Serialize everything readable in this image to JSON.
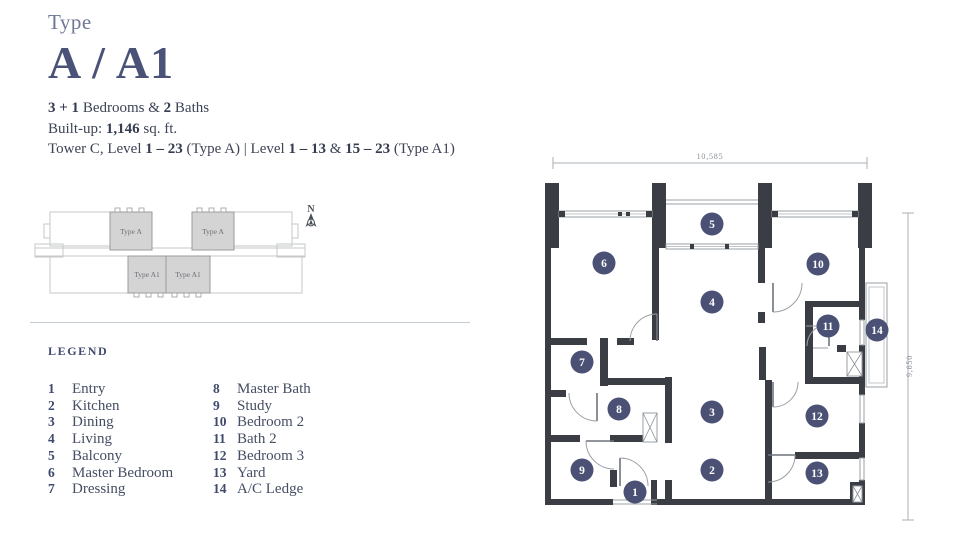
{
  "header": {
    "type_label": "Type",
    "title": "A / A1",
    "specs": {
      "beds_bold": "3 + 1",
      "beds_text": " Bedrooms & ",
      "baths_bold": "2",
      "baths_text": " Baths",
      "builtup_label": "Built-up: ",
      "builtup_value": "1,146",
      "builtup_suffix": " sq. ft.",
      "tower_prefix": "Tower C, Level ",
      "tower_range_a": "1 – 23",
      "tower_mid": " (Type A)  |  Level ",
      "tower_range_b1": "1 – 13",
      "tower_amp": " & ",
      "tower_range_b2": "15 – 23",
      "tower_suffix": " (Type A1)"
    }
  },
  "siteplan": {
    "north_label": "N",
    "blocks": [
      "Type A",
      "Type A",
      "Type A1",
      "Type A1"
    ]
  },
  "legend": {
    "title": "LEGEND",
    "col1": [
      {
        "num": "1",
        "label": "Entry"
      },
      {
        "num": "2",
        "label": "Kitchen"
      },
      {
        "num": "3",
        "label": "Dining"
      },
      {
        "num": "4",
        "label": "Living"
      },
      {
        "num": "5",
        "label": "Balcony"
      },
      {
        "num": "6",
        "label": "Master Bedroom"
      },
      {
        "num": "7",
        "label": "Dressing"
      }
    ],
    "col2": [
      {
        "num": "8",
        "label": "Master Bath"
      },
      {
        "num": "9",
        "label": "Study"
      },
      {
        "num": "10",
        "label": "Bedroom 2"
      },
      {
        "num": "11",
        "label": "Bath 2"
      },
      {
        "num": "12",
        "label": "Bedroom 3"
      },
      {
        "num": "13",
        "label": "Yard"
      },
      {
        "num": "14",
        "label": "A/C Ledge"
      }
    ]
  },
  "floorplan": {
    "width_label": "10,585",
    "height_label": "9,650",
    "rooms": [
      {
        "num": "1",
        "name": "Entry"
      },
      {
        "num": "2",
        "name": "Kitchen"
      },
      {
        "num": "3",
        "name": "Dining"
      },
      {
        "num": "4",
        "name": "Living"
      },
      {
        "num": "5",
        "name": "Balcony"
      },
      {
        "num": "6",
        "name": "Master Bedroom"
      },
      {
        "num": "7",
        "name": "Dressing"
      },
      {
        "num": "8",
        "name": "Master Bath"
      },
      {
        "num": "9",
        "name": "Study"
      },
      {
        "num": "10",
        "name": "Bedroom 2"
      },
      {
        "num": "11",
        "name": "Bath 2"
      },
      {
        "num": "12",
        "name": "Bedroom 3"
      },
      {
        "num": "13",
        "name": "Yard"
      },
      {
        "num": "14",
        "name": "A/C Ledge"
      }
    ]
  },
  "colors": {
    "accent": "#4a5377",
    "wall": "#3a3d44",
    "marker": "#4b5175",
    "siteplan_fill": "#d4d4d4"
  }
}
